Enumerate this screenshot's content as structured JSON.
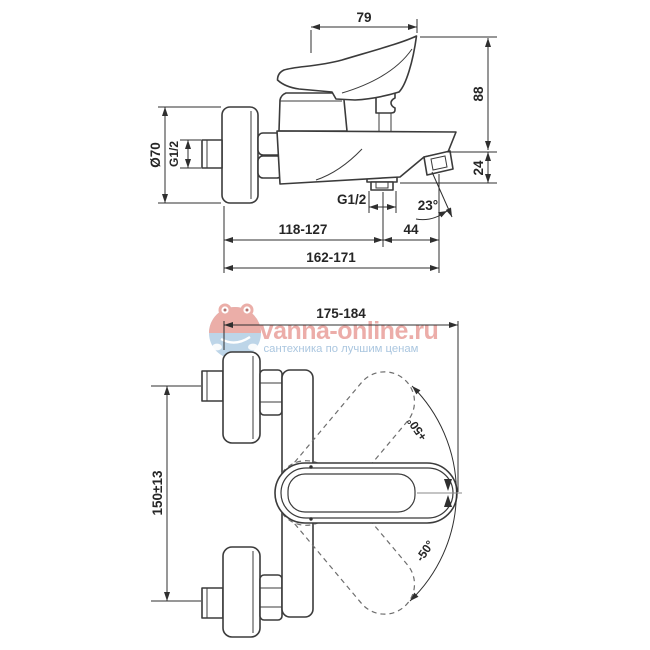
{
  "drawing": {
    "background": "#ffffff",
    "line_color": "#3b3b3b",
    "dimension_color": "#2f2f2f"
  },
  "side_view": {
    "description": "bath mixer side elevation",
    "dims": {
      "lever_length": "79",
      "height": "88",
      "spout_drop": "24",
      "spout_angle": "23°",
      "escutcheon_diameter": "Ø70",
      "inlet_thread": "G1/2",
      "outlet_thread": "G1/2",
      "wall_to_outlet": "118-127",
      "outlet_to_tip": "44",
      "total_depth": "162-171"
    }
  },
  "plan_view": {
    "description": "bath mixer plan view",
    "dims": {
      "overall_width": "175-184",
      "inlet_centers": "150±13",
      "lever_swing_up": "+50°",
      "lever_swing_down": "-50°"
    }
  },
  "watermark": {
    "brand": "vanna-online.ru",
    "tagline": "сантехника по лучшим ценам",
    "brand_color": "#e2817a",
    "tagline_color": "#97b9d8"
  }
}
